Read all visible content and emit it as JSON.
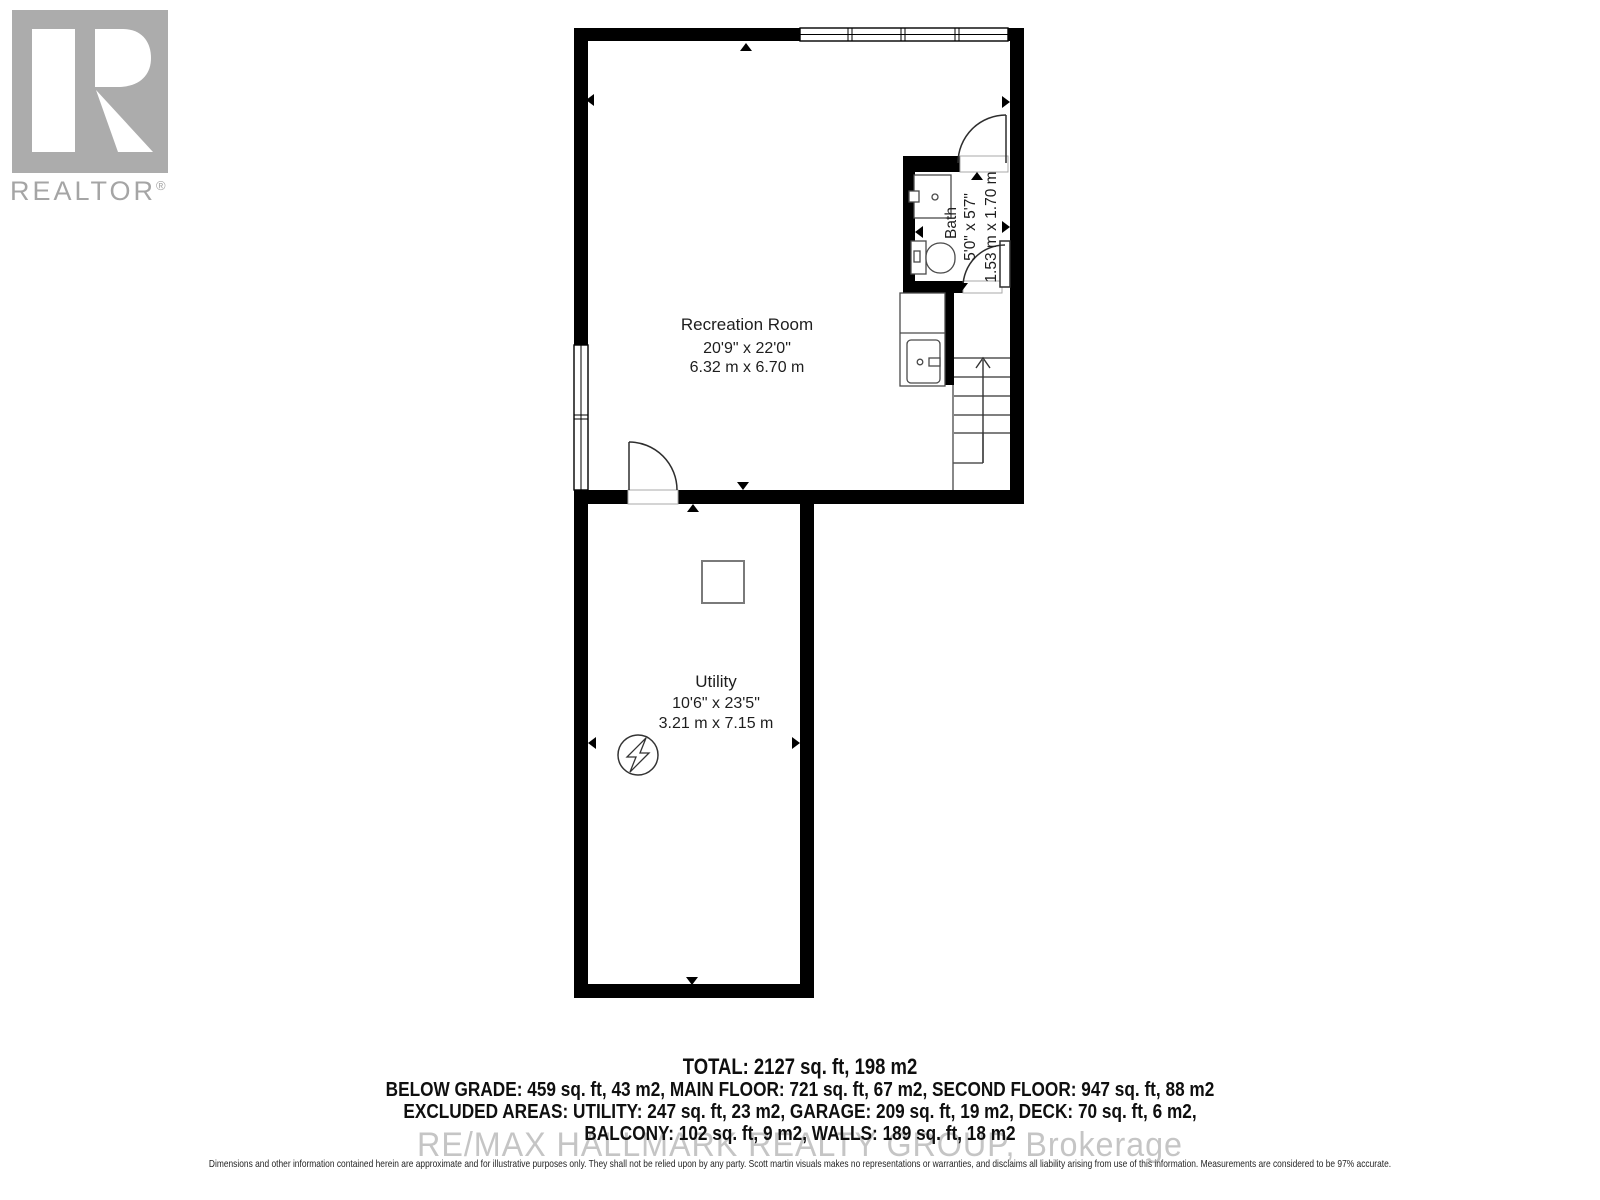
{
  "branding": {
    "logo_text": "REALTOR",
    "registered_mark": "®",
    "logo_gray": "#acacac"
  },
  "rooms": [
    {
      "name": "Recreation Room",
      "dims_imperial": "20'9\" x 22'0\"",
      "dims_metric": "6.32 m x 6.70 m"
    },
    {
      "name": "Bath",
      "dims_imperial": "5'0\" x 5'7\"",
      "dims_metric": "1.53 m x 1.70 m"
    },
    {
      "name": "Utility",
      "dims_imperial": "10'6\" x 23'5\"",
      "dims_metric": "3.21 m x 7.15 m"
    }
  ],
  "summary": {
    "total": "TOTAL: 2127 sq. ft, 198 m2",
    "line2": "BELOW GRADE: 459 sq. ft, 43 m2, MAIN FLOOR: 721 sq. ft, 67 m2, SECOND FLOOR: 947 sq. ft, 88 m2",
    "line3": "EXCLUDED AREAS: UTILITY: 247 sq. ft, 23 m2, GARAGE: 209 sq. ft, 19 m2, DECK: 70 sq. ft, 6 m2,",
    "line4": "BALCONY: 102 sq. ft, 9 m2, WALLS: 189 sq. ft, 18 m2"
  },
  "watermark": "RE/MAX HALLMARK REALTY GROUP, Brokerage",
  "disclaimer": "Dimensions and other information contained herein are approximate and for illustrative purposes only. They shall not be relied upon by any party. Scott martin visuals makes no representations or warranties, and disclaims all liability arising from use of this information. Measurements are considered to be 97% accurate.",
  "colors": {
    "wall": "#000000",
    "fixture_line": "#444444",
    "stair_line": "#555555"
  }
}
